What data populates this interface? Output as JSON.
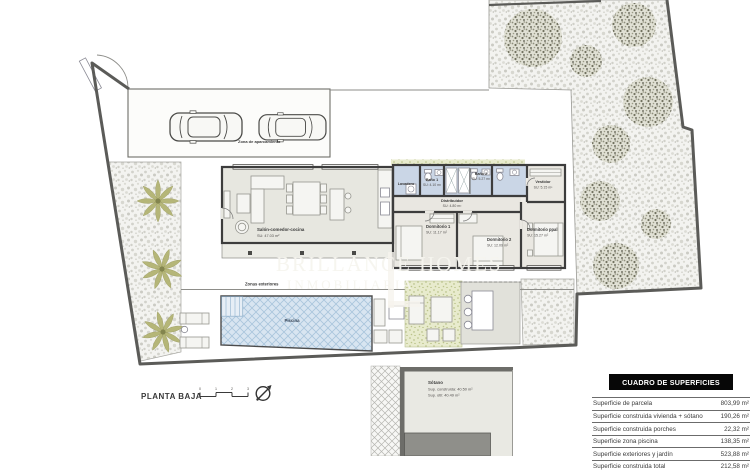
{
  "watermark": {
    "brand": "BRILLANCE HOMES",
    "sub": "INMOBILIARIA"
  },
  "plan": {
    "floor_label": "PLANTA BAJA",
    "parking_label": "Zona de aparcamiento",
    "exterior_label": "Zonas exteriores",
    "pool_label": "Piscina",
    "salon": {
      "name": "Salón-comedor-cocina",
      "area": "SU: 47.03 m²"
    },
    "rooms": [
      {
        "name": "Lavadero",
        "area": ""
      },
      {
        "name": "Baño 1",
        "area": "SU: 4.10 m²"
      },
      {
        "name": "Baño 2",
        "area": "SU: 5.27 m²"
      },
      {
        "name": "Vestidor",
        "area": "SU: 5.15 m²"
      },
      {
        "name": "Distribuidor",
        "area": "SU: 4.80 m²"
      },
      {
        "name": "Dormitorio 1",
        "area": "SU: 11.17 m²"
      },
      {
        "name": "Dormitorio 2",
        "area": "SU: 12.09 m²"
      },
      {
        "name": "Dormitorio ppal",
        "area": "SU: 15.27 m²"
      }
    ],
    "basement": {
      "name": "Sótano",
      "built": "Sup. construida: 40.50 m²",
      "useful": "Sup. útil: 40.49 m²"
    },
    "scale_ticks": [
      "0",
      "1",
      "2",
      "3"
    ]
  },
  "surfaces_table": {
    "title": "CUADRO DE SUPERFICIES",
    "rows": [
      {
        "label": "Superficie de parcela",
        "value": "803,99 m²"
      },
      {
        "label": "Superficie construida vivienda + sótano",
        "value": "190,26 m²"
      },
      {
        "label": "Superficie construida porches",
        "value": "22,32 m²"
      },
      {
        "label": "Superficie zona piscina",
        "value": "138,35 m²"
      },
      {
        "label": "Superficie exteriores y jardín",
        "value": "523,88 m²"
      },
      {
        "label": "Superficie construida total",
        "value": "212,58 m²"
      }
    ]
  },
  "colors": {
    "boundary": "#5b5b58",
    "wall": "#3d3d3d",
    "water": "#d8e5f1",
    "bath_floor": "#cad6e6",
    "gravel": "#f3f3f0",
    "lawn": "#e8ebcd",
    "palm": "#b5b678",
    "table_header_bg": "#070707"
  }
}
